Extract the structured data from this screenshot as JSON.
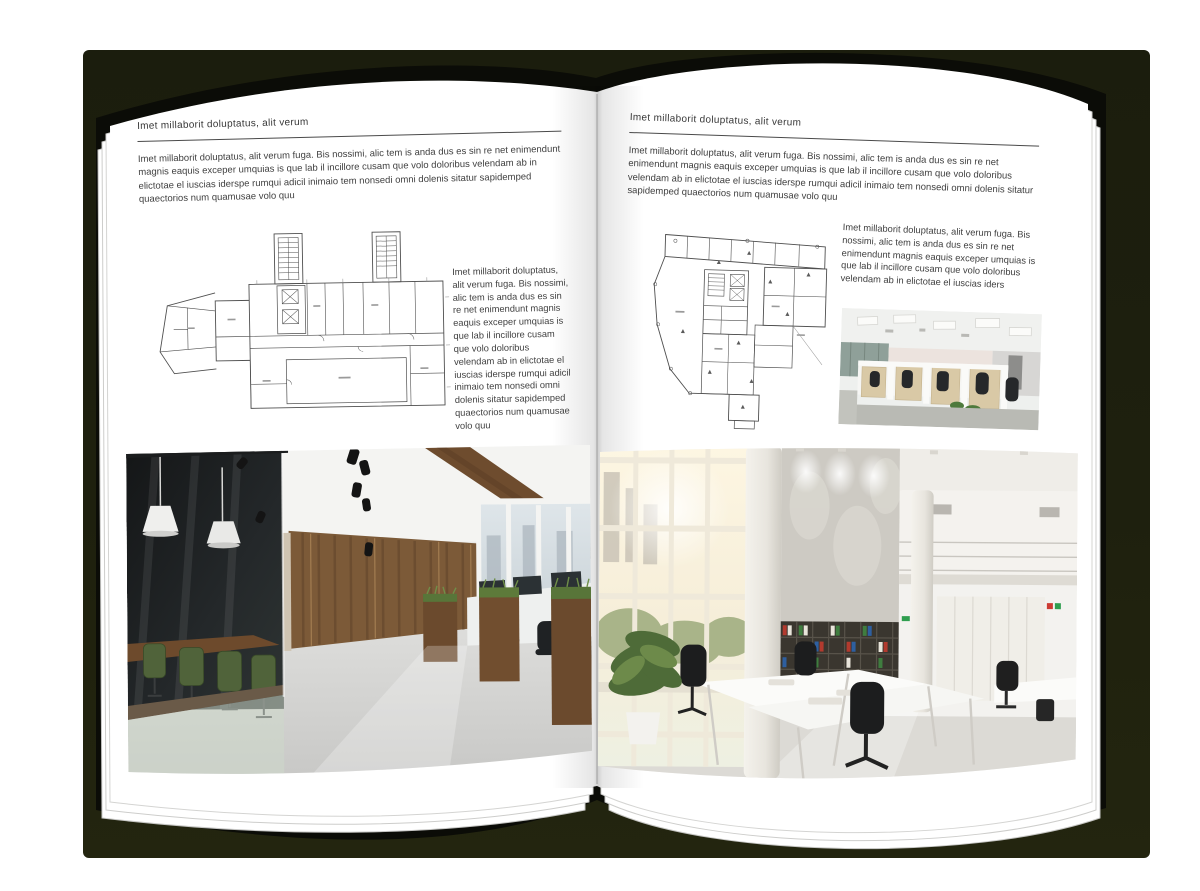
{
  "colors": {
    "backdrop": "#1d1f0e",
    "page": "#ffffff",
    "text": "#3d3d3d",
    "rule": "#4a4a4a"
  },
  "left_page": {
    "kicker": "Imet millaborit doluptatus, alit verum",
    "intro": "Imet millaborit doluptatus, alit verum fuga. Bis nossimi, alic tem is anda dus es sin re net enimendunt magnis eaquis exceper umquias is que lab il incillore cusam que volo doloribus velendam ab in elictotae el iuscias iderspe rumqui adicil inimaio tem nonsedi omni dolenis sitatur sapidemped quaectorios num quamusae volo quu",
    "side_text": "Imet millaborit doluptatus, alit verum fuga. Bis nossimi, alic tem is anda dus es sin re net enimendunt magnis eaquis exceper umquias is que lab il incillore cusam que volo doloribus velendam ab in elictotae el iuscias iderspe rumqui adicil inimaio tem nonsedi omni dolenis sitatur sapidemped quaectorios num quamusae volo quu"
  },
  "right_page": {
    "kicker": "Imet millaborit doluptatus, alit verum",
    "intro": "Imet millaborit doluptatus, alit verum fuga. Bis nossimi, alic tem is anda dus es sin re net enimendunt magnis eaquis exceper umquias is que lab il incillore cusam que volo doloribus velendam ab in elictotae el iuscias iderspe rumqui adicil inimaio tem nonsedi omni dolenis sitatur sapidemped quaectorios num quamusae volo quu",
    "side_text": "Imet millaborit doluptatus, alit verum fuga. Bis nossimi, alic tem is anda dus es sin re net enimendunt magnis eaquis exceper umquias is que lab il incillore cusam que volo doloribus velendam ab in elictotae el iuscias iders"
  },
  "media": {
    "left_floor_plan": "floor-plan-drawing",
    "right_floor_plan": "floor-plan-drawing",
    "left_photo": "office-interior-photo",
    "right_photo_large": "office-atrium-photo",
    "right_photo_small": "office-cubicles-photo"
  }
}
